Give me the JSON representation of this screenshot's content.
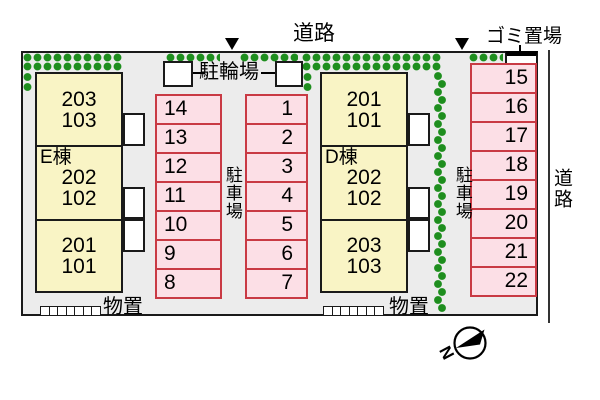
{
  "labels": {
    "road_top": "道路",
    "road_right": "道路",
    "garbage": "ゴミ置場",
    "bicycle_parking": "駐輪場",
    "parking_lot_left": "駐車場",
    "parking_lot_right": "駐車場",
    "storage_left": "物置",
    "storage_right": "物置",
    "compass_north": "N"
  },
  "buildings": [
    {
      "name": "E棟",
      "units": {
        "top": [
          "203",
          "103"
        ],
        "middle": [
          "202",
          "102"
        ],
        "bottom": [
          "201",
          "101"
        ]
      }
    },
    {
      "name": "D棟",
      "units": {
        "top": [
          "201",
          "101"
        ],
        "middle": [
          "202",
          "102"
        ],
        "bottom": [
          "203",
          "103"
        ]
      }
    }
  ],
  "parking_spaces": {
    "left_column": [
      "14",
      "13",
      "12",
      "11",
      "10",
      "9",
      "8"
    ],
    "middle_column": [
      "1",
      "2",
      "3",
      "4",
      "5",
      "6",
      "7"
    ],
    "right_column": [
      "15",
      "16",
      "17",
      "18",
      "19",
      "20",
      "21",
      "22"
    ]
  },
  "colors": {
    "site_background": "#ececec",
    "building_fill": "#f9f4c5",
    "parking_fill": "#fcdfe6",
    "parking_border": "#c93a44",
    "hedge_green": "#1e8e1e",
    "outline_black": "#1a1a1a"
  }
}
